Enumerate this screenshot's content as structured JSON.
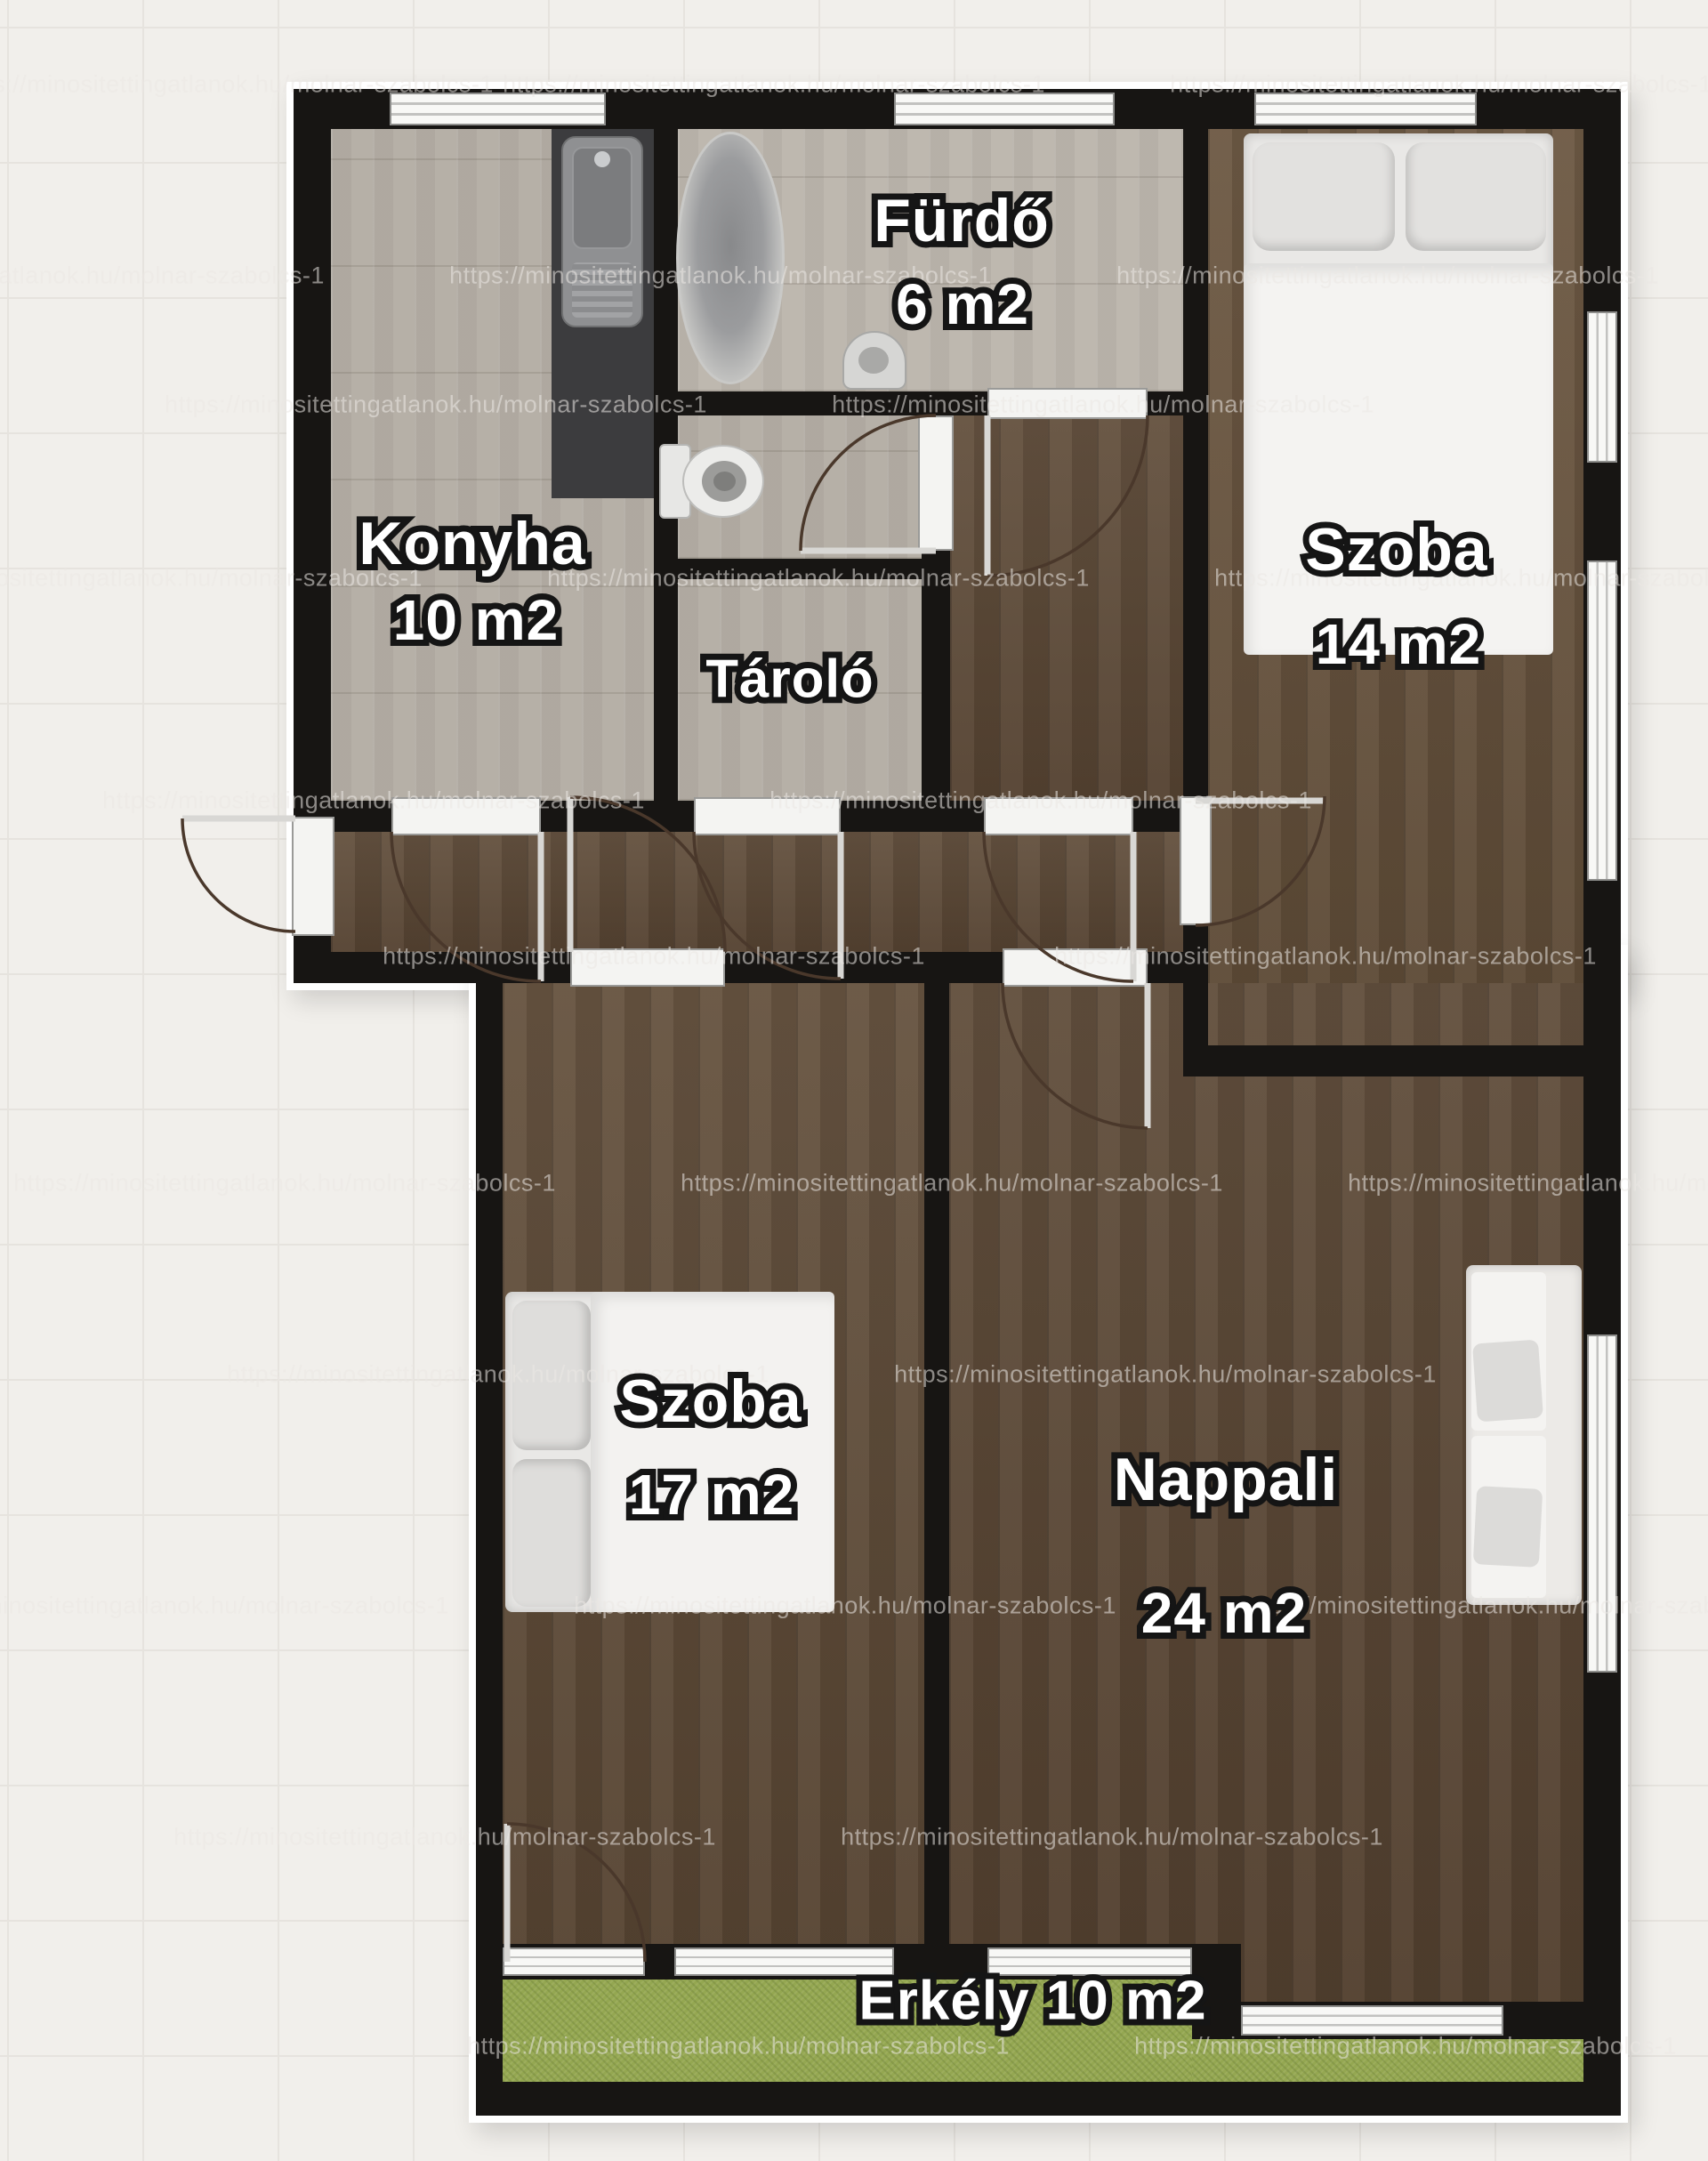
{
  "plan": {
    "rooms": {
      "konyha": {
        "name": "Konyha",
        "area": "10 m2"
      },
      "furdo": {
        "name": "Fürdő",
        "area": "6 m2"
      },
      "tarolo": {
        "name": "Tároló"
      },
      "szoba14": {
        "name": "Szoba",
        "area": "14 m2"
      },
      "szoba17": {
        "name": "Szoba",
        "area": "17 m2"
      },
      "nappali": {
        "name": "Nappali",
        "area": "24 m2"
      },
      "erkely": {
        "name": "Erkély 10 m2"
      }
    },
    "colors": {
      "wall": "#171513",
      "tile_floor": "#b6b0a7",
      "wood_floor": "#5d4936",
      "balcony_grass": "#94a751",
      "background": "#f1efeb"
    }
  },
  "watermark": {
    "text": "https://minositettingatlanok.hu/molnar-szabolcs-1",
    "positions": [
      [
        250,
        95
      ],
      [
        870,
        95
      ],
      [
        1620,
        95
      ],
      [
        60,
        310
      ],
      [
        810,
        310
      ],
      [
        1560,
        310
      ],
      [
        490,
        455
      ],
      [
        1240,
        455
      ],
      [
        170,
        650
      ],
      [
        920,
        650
      ],
      [
        1670,
        650
      ],
      [
        420,
        900
      ],
      [
        1170,
        900
      ],
      [
        735,
        1075
      ],
      [
        1490,
        1075
      ],
      [
        320,
        1330
      ],
      [
        1070,
        1330
      ],
      [
        1820,
        1330
      ],
      [
        560,
        1545
      ],
      [
        1310,
        1545
      ],
      [
        200,
        1805
      ],
      [
        950,
        1805
      ],
      [
        1700,
        1805
      ],
      [
        500,
        2065
      ],
      [
        1250,
        2065
      ],
      [
        830,
        2300
      ],
      [
        1580,
        2300
      ]
    ]
  }
}
